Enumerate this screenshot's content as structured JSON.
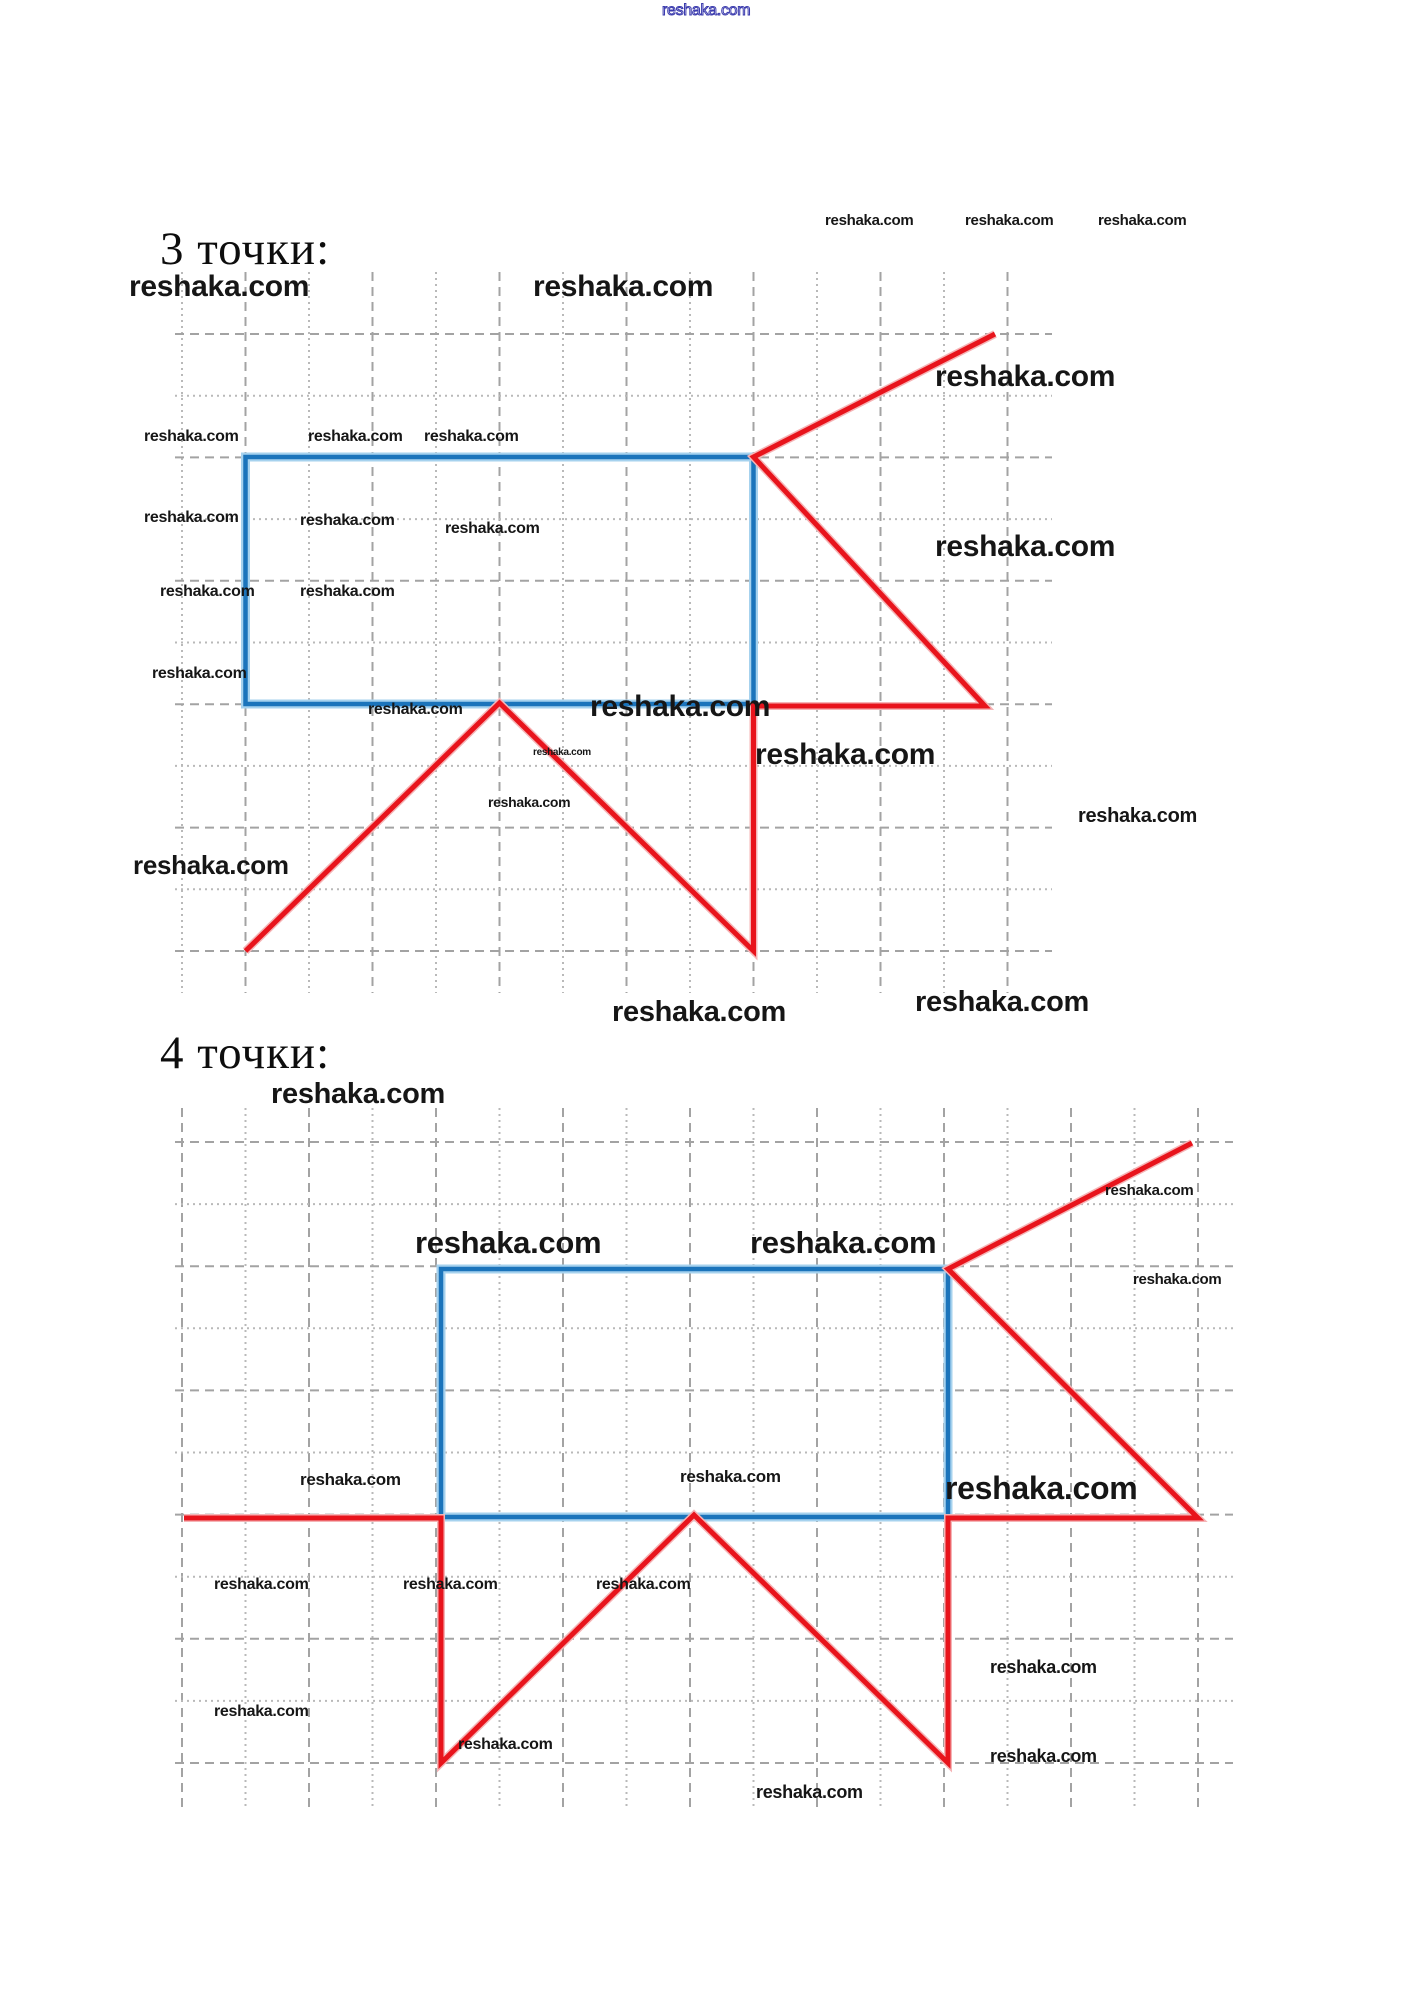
{
  "page": {
    "width": 1427,
    "height": 1993,
    "background": "#ffffff"
  },
  "colors": {
    "blue_core": "#1b74bb",
    "blue_halo": "#a6d2ee",
    "red_core": "#e8141c",
    "red_halo": "#f5b4b6",
    "grid_dashed": "#a3a3a3",
    "grid_dotted": "#b9b9b9",
    "heading_text": "#0d0d0d",
    "watermark_text": "#161616",
    "watermark_outline": "#3a3aad"
  },
  "headings": [
    {
      "id": "points3",
      "text": "3 точки:",
      "x": 160,
      "y": 226,
      "size": 47
    },
    {
      "id": "points4",
      "text": "4 точки:",
      "x": 160,
      "y": 1030,
      "size": 47
    }
  ],
  "figures": [
    {
      "name": "figure-3-points",
      "grid": {
        "x_first": 182,
        "x_step": 63.5,
        "x_count": 14,
        "y_top": 272,
        "y_bottom": 993,
        "v_first_style": "dotted",
        "y_first": 334,
        "y_step": 61.7,
        "y_count": 11,
        "x_left": 175,
        "x_right": 1052,
        "h_first_style": "dashed"
      },
      "rectangle": {
        "x1": 245.5,
        "y1": 457,
        "x2": 753.5,
        "y2": 704
      },
      "red_path": [
        [
          995,
          334
        ],
        [
          753.5,
          457
        ],
        [
          985,
          706
        ],
        [
          753.5,
          706
        ],
        [
          753.5,
          951
        ],
        [
          499.5,
          703
        ],
        [
          245.5,
          951
        ]
      ]
    },
    {
      "name": "figure-4-points",
      "grid": {
        "x_first": 182,
        "x_step": 63.5,
        "x_count": 17,
        "y_top": 1108,
        "y_bottom": 1810,
        "v_first_style": "dashed",
        "y_first": 1142,
        "y_step": 62.1,
        "y_count": 11,
        "x_left": 175,
        "x_right": 1233,
        "h_first_style": "dashed"
      },
      "rectangle": {
        "x1": 441,
        "y1": 1269,
        "x2": 948,
        "y2": 1517
      },
      "red_path": [
        [
          184,
          1518
        ],
        [
          441,
          1518
        ],
        [
          441,
          1763
        ],
        [
          694,
          1515
        ],
        [
          948,
          1763
        ],
        [
          948,
          1518
        ],
        [
          1198,
          1518
        ],
        [
          948,
          1269
        ],
        [
          1192,
          1143
        ]
      ]
    }
  ],
  "watermarks": [
    {
      "text": "reshaka.com",
      "x": 662,
      "y": 3,
      "size": 16,
      "weight": 400,
      "style": "outline"
    },
    {
      "text": "reshaka.com",
      "x": 825,
      "y": 213,
      "size": 15,
      "weight": 600,
      "style": "plain"
    },
    {
      "text": "reshaka.com",
      "x": 965,
      "y": 213,
      "size": 15,
      "weight": 600,
      "style": "plain"
    },
    {
      "text": "reshaka.com",
      "x": 1098,
      "y": 213,
      "size": 15,
      "weight": 600,
      "style": "plain"
    },
    {
      "text": "reshaka.com",
      "x": 129,
      "y": 272,
      "size": 30,
      "weight": 700,
      "style": "plain"
    },
    {
      "text": "reshaka.com",
      "x": 533,
      "y": 272,
      "size": 30,
      "weight": 700,
      "style": "plain"
    },
    {
      "text": "reshaka.com",
      "x": 935,
      "y": 362,
      "size": 30,
      "weight": 700,
      "style": "plain"
    },
    {
      "text": "reshaka.com",
      "x": 144,
      "y": 429,
      "size": 16,
      "weight": 700,
      "style": "plain"
    },
    {
      "text": "reshaka.com",
      "x": 308,
      "y": 429,
      "size": 16,
      "weight": 700,
      "style": "plain"
    },
    {
      "text": "reshaka.com",
      "x": 424,
      "y": 429,
      "size": 16,
      "weight": 700,
      "style": "plain"
    },
    {
      "text": "reshaka.com",
      "x": 144,
      "y": 510,
      "size": 16,
      "weight": 700,
      "style": "plain"
    },
    {
      "text": "reshaka.com",
      "x": 300,
      "y": 513,
      "size": 16,
      "weight": 700,
      "style": "plain"
    },
    {
      "text": "reshaka.com",
      "x": 445,
      "y": 521,
      "size": 16,
      "weight": 700,
      "style": "plain"
    },
    {
      "text": "reshaka.com",
      "x": 935,
      "y": 532,
      "size": 30,
      "weight": 700,
      "style": "plain"
    },
    {
      "text": "reshaka.com",
      "x": 160,
      "y": 584,
      "size": 16,
      "weight": 700,
      "style": "plain"
    },
    {
      "text": "reshaka.com",
      "x": 300,
      "y": 584,
      "size": 16,
      "weight": 700,
      "style": "plain"
    },
    {
      "text": "reshaka.com",
      "x": 152,
      "y": 666,
      "size": 16,
      "weight": 700,
      "style": "plain"
    },
    {
      "text": "reshaka.com",
      "x": 368,
      "y": 702,
      "size": 16,
      "weight": 700,
      "style": "plain"
    },
    {
      "text": "reshaka.com",
      "x": 590,
      "y": 692,
      "size": 30,
      "weight": 700,
      "style": "plain"
    },
    {
      "text": "reshaka.com",
      "x": 755,
      "y": 740,
      "size": 30,
      "weight": 700,
      "style": "plain"
    },
    {
      "text": "reshaka.com",
      "x": 533,
      "y": 748,
      "size": 10,
      "weight": 700,
      "style": "plain"
    },
    {
      "text": "reshaka.com",
      "x": 488,
      "y": 795,
      "size": 14,
      "weight": 700,
      "style": "plain"
    },
    {
      "text": "reshaka.com",
      "x": 1078,
      "y": 806,
      "size": 20,
      "weight": 700,
      "style": "plain"
    },
    {
      "text": "reshaka.com",
      "x": 133,
      "y": 852,
      "size": 26,
      "weight": 700,
      "style": "plain"
    },
    {
      "text": "reshaka.com",
      "x": 612,
      "y": 998,
      "size": 29,
      "weight": 700,
      "style": "plain"
    },
    {
      "text": "reshaka.com",
      "x": 915,
      "y": 988,
      "size": 29,
      "weight": 700,
      "style": "plain"
    },
    {
      "text": "reshaka.com",
      "x": 271,
      "y": 1080,
      "size": 29,
      "weight": 700,
      "style": "plain"
    },
    {
      "text": "reshaka.com",
      "x": 1105,
      "y": 1183,
      "size": 15,
      "weight": 700,
      "style": "plain"
    },
    {
      "text": "reshaka.com",
      "x": 415,
      "y": 1227,
      "size": 31,
      "weight": 700,
      "style": "plain"
    },
    {
      "text": "reshaka.com",
      "x": 750,
      "y": 1227,
      "size": 31,
      "weight": 700,
      "style": "plain"
    },
    {
      "text": "reshaka.com",
      "x": 1133,
      "y": 1272,
      "size": 15,
      "weight": 700,
      "style": "plain"
    },
    {
      "text": "reshaka.com",
      "x": 945,
      "y": 1472,
      "size": 32,
      "weight": 700,
      "style": "plain"
    },
    {
      "text": "reshaka.com",
      "x": 300,
      "y": 1471,
      "size": 17,
      "weight": 700,
      "style": "plain"
    },
    {
      "text": "reshaka.com",
      "x": 680,
      "y": 1468,
      "size": 17,
      "weight": 700,
      "style": "plain"
    },
    {
      "text": "reshaka.com",
      "x": 214,
      "y": 1577,
      "size": 16,
      "weight": 700,
      "style": "plain"
    },
    {
      "text": "reshaka.com",
      "x": 403,
      "y": 1577,
      "size": 16,
      "weight": 700,
      "style": "plain"
    },
    {
      "text": "reshaka.com",
      "x": 596,
      "y": 1577,
      "size": 16,
      "weight": 700,
      "style": "plain"
    },
    {
      "text": "reshaka.com",
      "x": 990,
      "y": 1658,
      "size": 18,
      "weight": 700,
      "style": "plain"
    },
    {
      "text": "reshaka.com",
      "x": 214,
      "y": 1704,
      "size": 16,
      "weight": 700,
      "style": "plain"
    },
    {
      "text": "reshaka.com",
      "x": 458,
      "y": 1737,
      "size": 16,
      "weight": 700,
      "style": "plain"
    },
    {
      "text": "reshaka.com",
      "x": 990,
      "y": 1747,
      "size": 18,
      "weight": 700,
      "style": "plain"
    },
    {
      "text": "reshaka.com",
      "x": 756,
      "y": 1783,
      "size": 18,
      "weight": 700,
      "style": "plain"
    }
  ]
}
